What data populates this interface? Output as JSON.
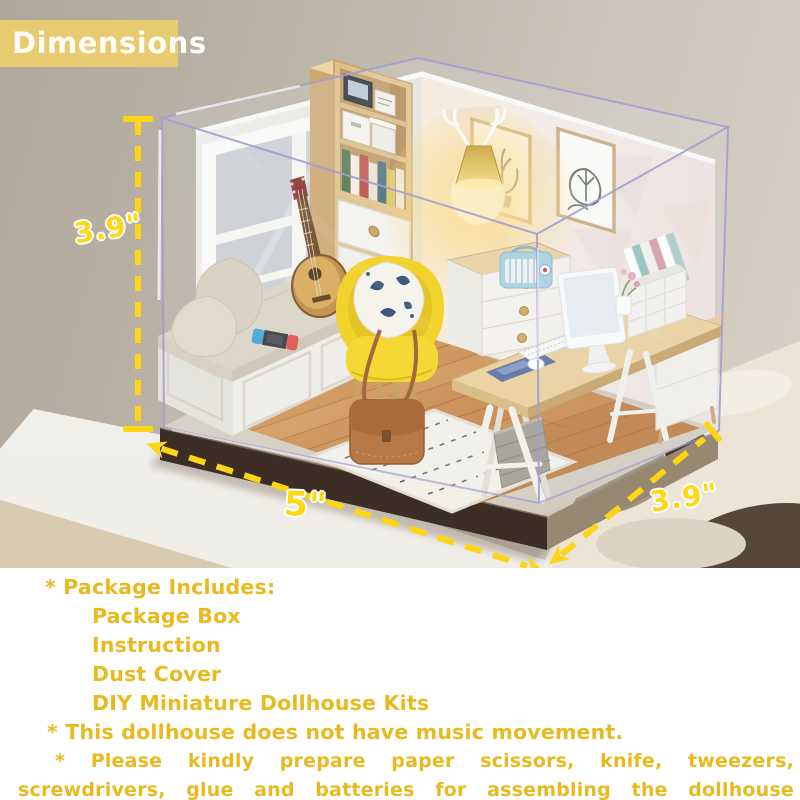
{
  "badge": {
    "label": "Dimensions"
  },
  "annotations": {
    "height": "3.9\"",
    "width": "5\"",
    "depth": "3.9\""
  },
  "caption": {
    "lines": [
      "* Package Includes:",
      "Package Box",
      "Instruction",
      "Dust Cover",
      "DIY Miniature Dollhouse Kits",
      "* This dollhouse does not have music movement.",
      "* Please kindly prepare paper scissors, knife, tweezers, screwdrivers, glue and batteries for assembling the dollhouse miniature."
    ]
  },
  "scene": {
    "alt": "DIY miniature dollhouse room inside a clear acrylic dust cover on a dark wooden base: window seat with cushions and game console, ukulele, bookshelf, antler wall lamp, two botanical wall prints, yellow armchair with patterned pillow and leather satchel, patterned rug, wooden trestle desk with computer monitor, keyboard, radio and storage"
  },
  "colors": {
    "annotation_yellow": "#ffd417",
    "caption_gold": "#e8ba20",
    "badge_background": "#e8ca70",
    "badge_text": "#ffffff",
    "chair_yellow": "#f5d41c",
    "base_brown": "#3c2e24"
  }
}
